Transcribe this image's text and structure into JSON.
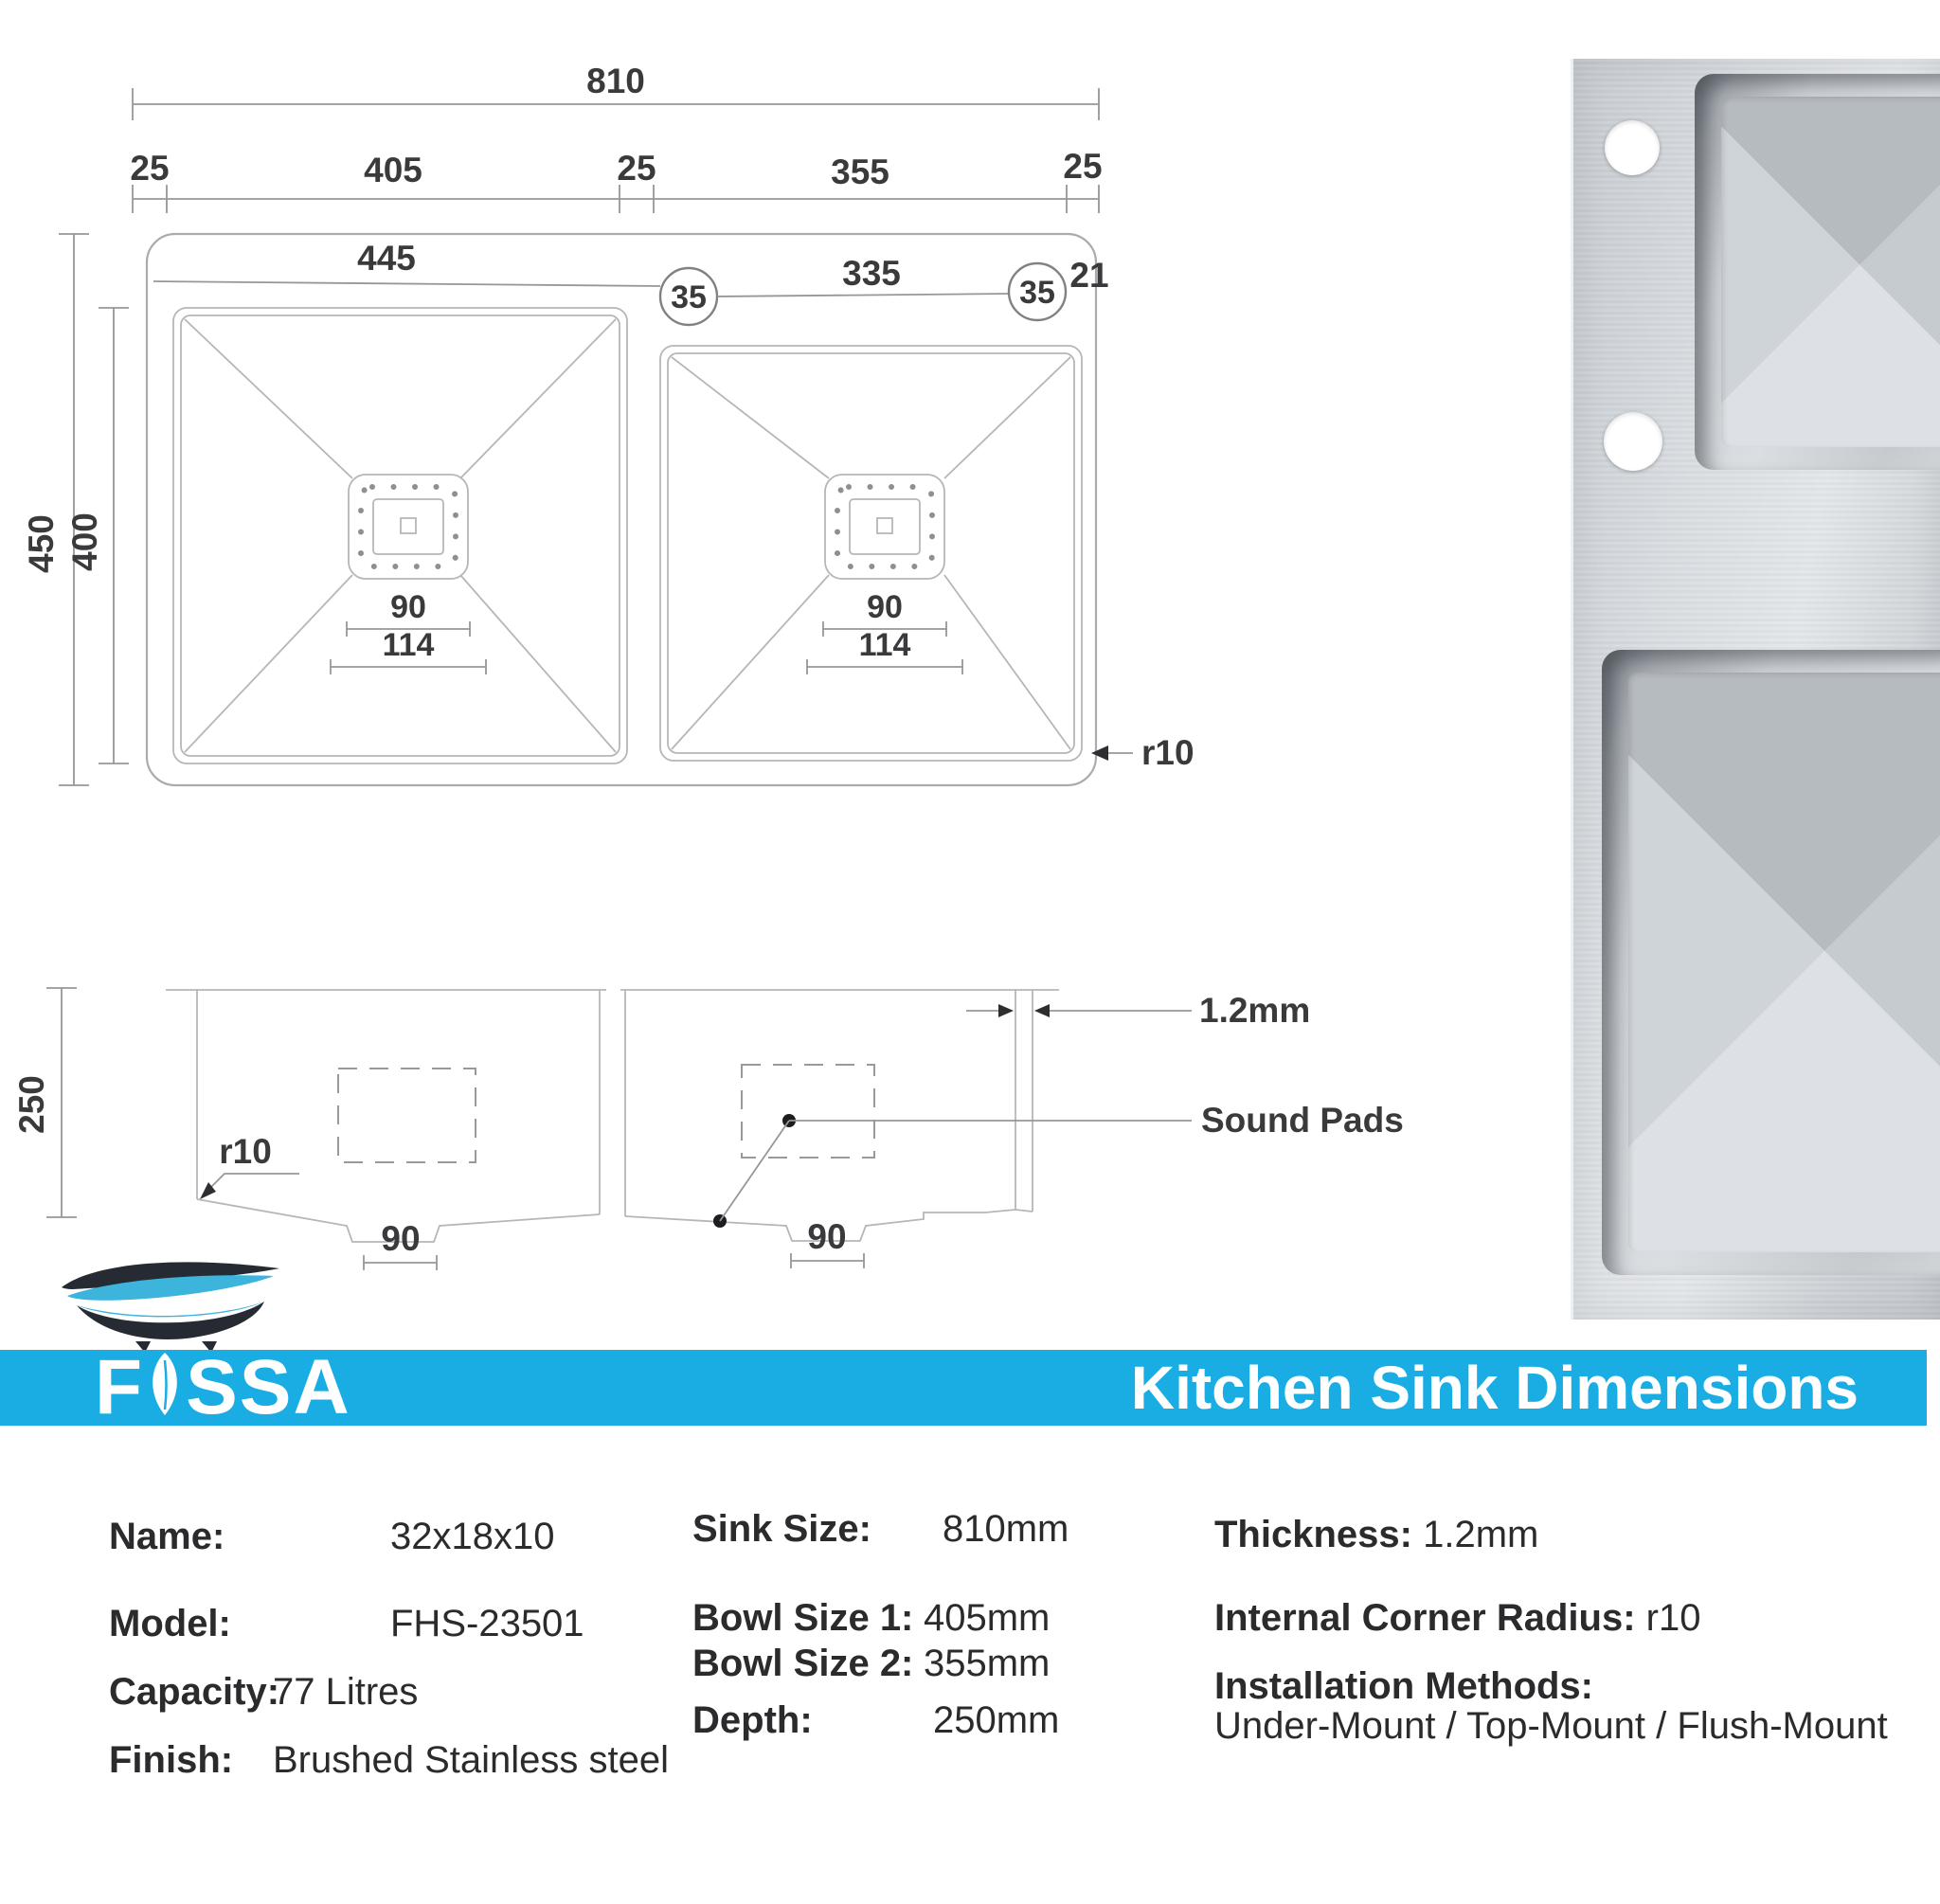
{
  "banner": {
    "title": "Kitchen Sink Dimensions",
    "color": "#19ade4"
  },
  "brand": {
    "first_letter": "F",
    "rest": "SSA",
    "leaf_icon": "leaf",
    "tub_icon": "bathtub",
    "dark_color": "#262b33",
    "blue_color": "#3cb4dc"
  },
  "top_view": {
    "total_width": "810",
    "chain": {
      "left_rim": "25",
      "bowl1": "405",
      "divider": "25",
      "bowl2": "355",
      "right_rim": "25"
    },
    "bowl1_width": "445",
    "bowl2_width": "335",
    "corner_badge_1": "35",
    "corner_badge_2": "35",
    "edge_gap": "21",
    "outer_height": "450",
    "bowl_height": "400",
    "bowl1_drain_width": "90",
    "bowl1_drain_flange": "114",
    "bowl2_drain_width": "90",
    "bowl2_drain_flange": "114",
    "corner_radius": "r10"
  },
  "side_view": {
    "depth": "250",
    "corner_radius": "r10",
    "bowl1_drain": "90",
    "bowl2_drain": "90",
    "thickness": "1.2mm",
    "sound_pads_label": "Sound Pads"
  },
  "specs": {
    "col1": [
      {
        "label": "Name:",
        "value": "32x18x10"
      },
      {
        "label": "Model:",
        "value": "FHS-23501"
      },
      {
        "label": "Capacity:",
        "value": "77 Litres"
      },
      {
        "label": "Finish:",
        "value": "Brushed Stainless steel"
      }
    ],
    "col2": [
      {
        "label": "Sink Size:",
        "value": "810mm"
      },
      {
        "label": "Bowl Size 1:",
        "value": "405mm"
      },
      {
        "label": "Bowl Size 2:",
        "value": "355mm"
      },
      {
        "label": "Depth:",
        "value": "250mm"
      }
    ],
    "col3": [
      {
        "label": "Thickness:",
        "value": "1.2mm"
      },
      {
        "label": "Internal Corner Radius:",
        "value": "r10"
      },
      {
        "label": "Installation Methods:",
        "value": ""
      },
      {
        "label": "",
        "value": "Under-Mount / Top-Mount / Flush-Mount"
      }
    ]
  }
}
